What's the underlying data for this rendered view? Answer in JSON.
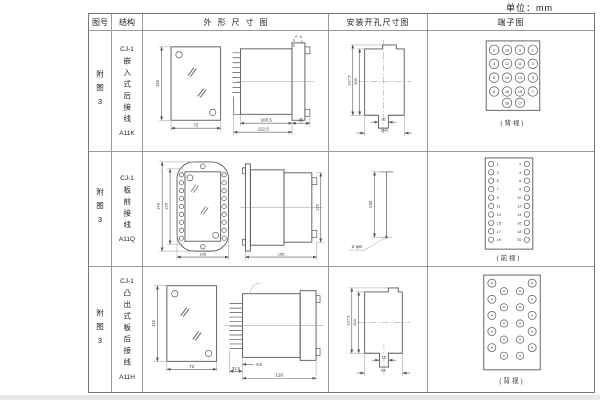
{
  "page": {
    "unit_label": "单位：mm"
  },
  "header": {
    "fig": "图号",
    "structure": "结构",
    "outline": "外形尺寸图",
    "install": "安装开孔尺寸图",
    "terminal": "端子图"
  },
  "rows": [
    {
      "fig_no": "附图3",
      "model": "CJ-1",
      "desc": "嵌入式后接线",
      "code": "A11K",
      "outline": {
        "front_h": "115",
        "front_w": "72",
        "body_len": "100.5",
        "total_len": "122.5",
        "flange_w": "35"
      },
      "install": {
        "h_outer": "107.5",
        "h_inner": "105",
        "notch_w": "16",
        "bottom_w": "(64)"
      },
      "terminal": {
        "caption": "(背视)",
        "grid": [
          [
            "2",
            "10",
            "9",
            "1"
          ],
          [
            "4",
            "12",
            "11",
            "3"
          ],
          [
            "6",
            "14",
            "13",
            "5"
          ],
          [
            "8",
            "16",
            "15",
            "7"
          ]
        ],
        "bottom_pair": [
          "18",
          "17"
        ]
      }
    },
    {
      "fig_no": "附图3",
      "model": "CJ-1",
      "desc": "板前接线",
      "code": "A11Q",
      "outline": {
        "front_h_outer": "149",
        "front_h_inner": "125",
        "front_w": "105",
        "side_len": "156",
        "side_h": "115"
      },
      "install": {
        "hole_spacing": "133",
        "hole_note": "2-φ6"
      },
      "terminal": {
        "caption": "(前视)",
        "left": [
          "1",
          "3",
          "5",
          "7",
          "9",
          "11",
          "13",
          "15",
          "17",
          "19"
        ],
        "right": [
          "2",
          "4",
          "6",
          "8",
          "10",
          "12",
          "14",
          "16",
          "18",
          "20"
        ]
      }
    },
    {
      "fig_no": "附图3",
      "model": "CJ-1",
      "desc": "凸出式板后接线",
      "code": "A11H",
      "outline": {
        "front_h": "115",
        "front_w": "72",
        "pins_len": "31.5",
        "gap": "9.5",
        "total_len": "126"
      },
      "install": {
        "h_outer": "107.5",
        "h_inner": "104",
        "slot_w": "16",
        "bottom_w": "64"
      },
      "terminal": {
        "caption": "(背视)"
      }
    }
  ]
}
